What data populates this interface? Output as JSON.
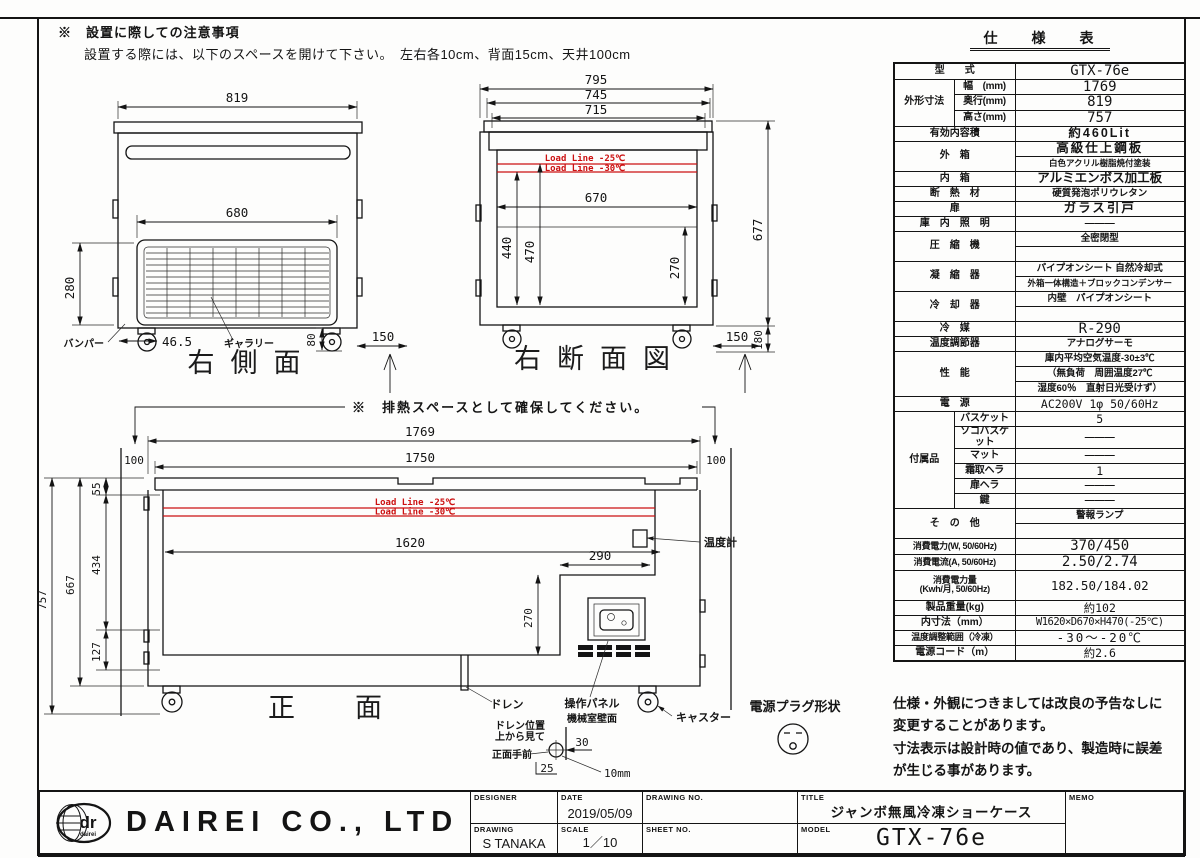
{
  "colors": {
    "accent_red": "#cc1111",
    "line": "#141414"
  },
  "page": {
    "top_note_1": "※　設置に際しての注意事項",
    "top_note_2": "設置する際には、以下のスペースを開けて下さい。　左右各10cm、背面15cm、天井100cm"
  },
  "views": {
    "side": {
      "title": "右側面",
      "w819": "819",
      "w680": "680",
      "h280": "280",
      "d465": "46.5",
      "d80": "80",
      "d150": "150",
      "bumper": "バンパー",
      "gallery": "ギャラリー"
    },
    "section": {
      "title": "右断面図",
      "t795": "795",
      "t745": "745",
      "t715": "715",
      "w670": "670",
      "v440": "440",
      "v470": "470",
      "v270": "270",
      "h677": "677",
      "h180": "180",
      "d150": "150",
      "ll25": "Load Line -25℃",
      "ll30": "Load Line -30℃"
    },
    "front": {
      "title": "正面",
      "note": "※　排熱スペースとして確保してください。",
      "w1769": "1769",
      "w1750": "1750",
      "g100l": "100",
      "g100r": "100",
      "h757": "757",
      "h667": "667",
      "h55": "55",
      "h434": "434",
      "h127": "127",
      "w1620": "1620",
      "w290": "290",
      "v270": "270",
      "ll25": "Load Line -25℃",
      "ll30": "Load Line -30℃",
      "thermometer": "温度計",
      "drain": "ドレン",
      "panel": "操作パネル",
      "caster": "キャスター"
    },
    "drain_detail": {
      "pos1": "ドレン位置",
      "pos2": "上から見て",
      "wall": "機械室壁面",
      "front": "正面手前",
      "d30": "30",
      "d25": "25",
      "d10": "10mm"
    },
    "plug": {
      "label": "電源プラグ形状"
    }
  },
  "spec_table": {
    "title": "仕　様　表",
    "rows": [
      {
        "cells": [
          {
            "t": "型　　式",
            "cs": 2,
            "cl": "lbl"
          },
          {
            "t": "GTX-76e",
            "cl": "val xl"
          }
        ]
      },
      {
        "cells": [
          {
            "t": "外形寸法",
            "rs": 3,
            "cl": "lbl g"
          },
          {
            "t": "幅　(mm)",
            "cl": "sub"
          },
          {
            "t": "1769",
            "cl": "val xl"
          }
        ]
      },
      {
        "cells": [
          {
            "t": "奥行(mm)",
            "cl": "sub"
          },
          {
            "t": "819",
            "cl": "val xl"
          }
        ]
      },
      {
        "cells": [
          {
            "t": "高さ(mm)",
            "cl": "sub"
          },
          {
            "t": "757",
            "cl": "val xl"
          }
        ]
      },
      {
        "cells": [
          {
            "t": "有効内容積",
            "cs": 2,
            "cl": "lbl"
          },
          {
            "t": "約460Lit",
            "cl": "val lg sp"
          }
        ]
      },
      {
        "cells": [
          {
            "t": "外　箱",
            "cs": 2,
            "rs": 2,
            "cl": "lbl"
          },
          {
            "t": "高級仕上鋼板",
            "cl": "val lg sp"
          }
        ]
      },
      {
        "cells": [
          {
            "t": "白色アクリル樹脂焼付塗装",
            "cl": "val sm"
          }
        ]
      },
      {
        "cells": [
          {
            "t": "内　箱",
            "cs": 2,
            "cl": "lbl"
          },
          {
            "t": "アルミエンボス加工板",
            "cl": "val lg"
          }
        ]
      },
      {
        "cells": [
          {
            "t": "断　熱　材",
            "cs": 2,
            "cl": "lbl"
          },
          {
            "t": "硬質発泡ポリウレタン",
            "cl": "val md"
          }
        ]
      },
      {
        "cells": [
          {
            "t": "扉",
            "cs": 2,
            "cl": "lbl"
          },
          {
            "t": "ガラス引戸",
            "cl": "val lg sp"
          }
        ]
      },
      {
        "cells": [
          {
            "t": "庫　内　照　明",
            "cs": 2,
            "cl": "lbl"
          },
          {
            "t": "———",
            "cl": "val"
          }
        ]
      },
      {
        "cells": [
          {
            "t": "圧　縮　機",
            "cs": 2,
            "rs": 2,
            "cl": "lbl"
          },
          {
            "t": "全密閉型",
            "cl": "val md"
          }
        ]
      },
      {
        "cells": [
          {
            "t": "",
            "cl": "val"
          }
        ]
      },
      {
        "cells": [
          {
            "t": "凝　縮　器",
            "cs": 2,
            "rs": 2,
            "cl": "lbl"
          },
          {
            "t": "パイプオンシート 自然冷却式",
            "cl": "val md"
          }
        ]
      },
      {
        "cells": [
          {
            "t": "外箱一体構造＋ブロックコンデンサー",
            "cl": "val sm"
          }
        ]
      },
      {
        "cells": [
          {
            "t": "冷　却　器",
            "cs": 2,
            "rs": 2,
            "cl": "lbl"
          },
          {
            "t": "内壁　パイプオンシート",
            "cl": "val md"
          }
        ]
      },
      {
        "cells": [
          {
            "t": "",
            "cl": "val"
          }
        ]
      },
      {
        "cells": [
          {
            "t": "冷　媒",
            "cs": 2,
            "cl": "lbl"
          },
          {
            "t": "R-290",
            "cl": "val xl"
          }
        ]
      },
      {
        "cells": [
          {
            "t": "温度調節器",
            "cs": 2,
            "cl": "lbl"
          },
          {
            "t": "アナログサーモ",
            "cl": "val md"
          }
        ]
      },
      {
        "cells": [
          {
            "t": "性　能",
            "cs": 2,
            "rs": 3,
            "cl": "lbl"
          },
          {
            "t": "庫内平均空気温度-30±3℃",
            "cl": "val md"
          }
        ]
      },
      {
        "cells": [
          {
            "t": "（無負荷　周囲温度27℃",
            "cl": "val md left"
          }
        ]
      },
      {
        "cells": [
          {
            "t": "湿度60％　直射日光受けず）",
            "cl": "val md"
          }
        ]
      },
      {
        "cells": [
          {
            "t": "電　源",
            "cs": 2,
            "cl": "lbl"
          },
          {
            "t": "AC200V 1φ 50/60Hz",
            "cl": "val md2"
          }
        ]
      },
      {
        "cells": [
          {
            "t": "付属品",
            "rs": 6,
            "cl": "lbl g"
          },
          {
            "t": "バスケット",
            "cl": "sub"
          },
          {
            "t": "5",
            "cl": "val md2"
          }
        ]
      },
      {
        "cells": [
          {
            "t": "ソコバスケット",
            "cl": "sub"
          },
          {
            "t": "———",
            "cl": "val"
          }
        ]
      },
      {
        "cells": [
          {
            "t": "マット",
            "cl": "sub"
          },
          {
            "t": "———",
            "cl": "val"
          }
        ]
      },
      {
        "cells": [
          {
            "t": "霜取ヘラ",
            "cl": "sub"
          },
          {
            "t": "1",
            "cl": "val md2"
          }
        ]
      },
      {
        "cells": [
          {
            "t": "扉ヘラ",
            "cl": "sub"
          },
          {
            "t": "———",
            "cl": "val"
          }
        ]
      },
      {
        "cells": [
          {
            "t": "鍵",
            "cl": "sub"
          },
          {
            "t": "———",
            "cl": "val"
          }
        ]
      },
      {
        "cells": [
          {
            "t": "そ　の　他",
            "cs": 2,
            "rs": 2,
            "cl": "lbl"
          },
          {
            "t": "警報ランプ",
            "cl": "val md"
          }
        ]
      },
      {
        "cells": [
          {
            "t": "",
            "cl": "val"
          }
        ]
      },
      {
        "cells": [
          {
            "t": "消費電力(W, 50/60Hz)",
            "cs": 2,
            "cl": "lbl tight"
          },
          {
            "t": "370/450",
            "cl": "val xl"
          }
        ]
      },
      {
        "cells": [
          {
            "t": "消費電流(A, 50/60Hz)",
            "cs": 2,
            "cl": "lbl tight"
          },
          {
            "t": "2.50/2.74",
            "cl": "val xl"
          }
        ]
      },
      {
        "h": 2,
        "cells": [
          {
            "t": "消費電力量\n(Kwh/月, 50/60Hz)",
            "cs": 2,
            "cl": "lbl tight"
          },
          {
            "t": "182.50/184.02",
            "cl": "val lg2"
          }
        ]
      },
      {
        "cells": [
          {
            "t": "製品重量(kg)",
            "cs": 2,
            "cl": "lbl"
          },
          {
            "t": "約102",
            "cl": "val md2"
          }
        ]
      },
      {
        "cells": [
          {
            "t": "内寸法（mm）",
            "cs": 2,
            "cl": "lbl"
          },
          {
            "t": "W1620×D670×H470(-25℃)",
            "cl": "val md2 tight"
          }
        ]
      },
      {
        "cells": [
          {
            "t": "温度調整範囲（冷凍）",
            "cs": 2,
            "cl": "lbl tight"
          },
          {
            "t": "-30〜-20℃",
            "cl": "val lg2 sp"
          }
        ]
      },
      {
        "cells": [
          {
            "t": "電源コード（m）",
            "cs": 2,
            "cl": "lbl"
          },
          {
            "t": "約2.6",
            "cl": "val md2"
          }
        ]
      }
    ]
  },
  "notes": {
    "l1": "仕様・外観につきましては改良の予告なしに",
    "l2": "変更することがあります。",
    "l3": "寸法表示は設計時の値であり、製造時に誤差",
    "l4": "が生じる事があります。"
  },
  "title_block": {
    "company": "DAIREI CO., LTD",
    "logo_text": "dr",
    "logo_sub": "dairei",
    "designer_label": "DESIGNER",
    "designer_value": "",
    "date_label": "DATE",
    "date_value": "2019/05/09",
    "drawing_label": "DRAWING",
    "drawing_value": "S TANAKA",
    "scale_label": "SCALE",
    "scale_value": "1／10",
    "drawing_no_label": "DRAWING NO.",
    "drawing_no_value": "",
    "sheet_no_label": "SHEET NO.",
    "sheet_no_value": "",
    "title_label": "TITLE",
    "title_value": "ジャンボ無風冷凍ショーケース",
    "model_label": "MODEL",
    "model_value": "GTX-76e",
    "memo_label": "MEMO",
    "memo_value": ""
  }
}
